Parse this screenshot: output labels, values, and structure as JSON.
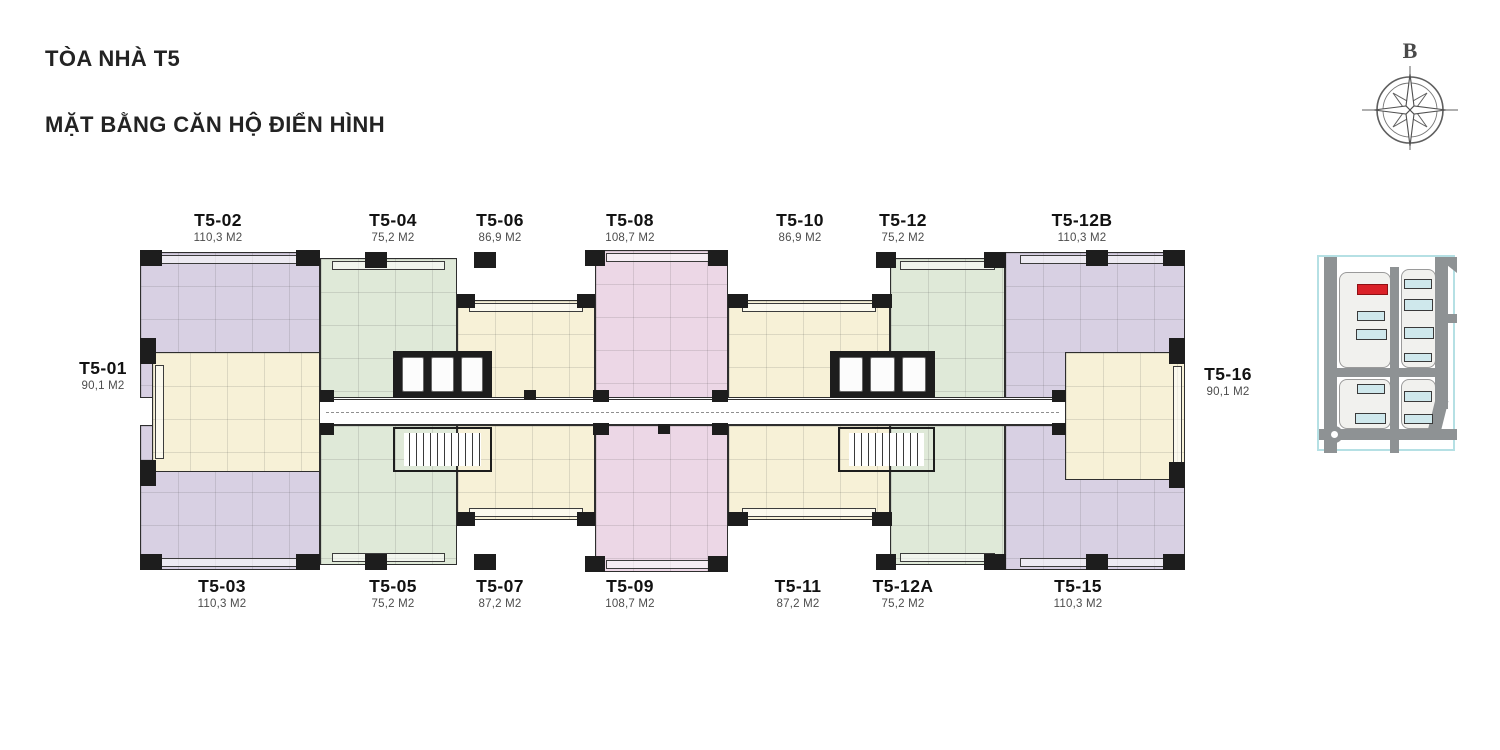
{
  "title": {
    "line1": "TÒA NHÀ T5",
    "line2": "MẶT BẰNG CĂN HỘ ĐIỂN HÌNH"
  },
  "compass": {
    "north_label": "B"
  },
  "colors": {
    "lavender": "#d8d0e3",
    "green": "#dfe9d8",
    "cream": "#f7f1d7",
    "pink": "#ecd7e6",
    "wall": "#1d1d1d",
    "map_road": "#8e9294",
    "map_building_blue": "#cfe8ec",
    "map_building_red": "#da2128",
    "map_border": "#b5e0e4"
  },
  "plan": {
    "units": [
      {
        "id": "T5-02",
        "label": "T5-02",
        "area": "110,3 M2",
        "color": "lavender",
        "rect": [
          140,
          252,
          180,
          146
        ],
        "label_at": [
          218,
          210
        ],
        "balcony": "top"
      },
      {
        "id": "T5-03",
        "label": "T5-03",
        "area": "110,3 M2",
        "color": "lavender",
        "rect": [
          140,
          425,
          180,
          145
        ],
        "label_at": [
          222,
          576
        ],
        "balcony": "bottom"
      },
      {
        "id": "T5-04",
        "label": "T5-04",
        "area": "75,2 M2",
        "color": "green",
        "rect": [
          320,
          258,
          137,
          140
        ],
        "label_at": [
          393,
          210
        ],
        "balcony": "top"
      },
      {
        "id": "T5-05",
        "label": "T5-05",
        "area": "75,2 M2",
        "color": "green",
        "rect": [
          320,
          425,
          137,
          140
        ],
        "label_at": [
          393,
          576
        ],
        "balcony": "bottom"
      },
      {
        "id": "T5-06",
        "label": "T5-06",
        "area": "86,9 M2",
        "color": "cream",
        "rect": [
          457,
          300,
          138,
          98
        ],
        "label_at": [
          500,
          210
        ],
        "balcony": "top"
      },
      {
        "id": "T5-07",
        "label": "T5-07",
        "area": "87,2 M2",
        "color": "cream",
        "rect": [
          457,
          425,
          138,
          95
        ],
        "label_at": [
          500,
          576
        ],
        "balcony": "bottom"
      },
      {
        "id": "T5-08",
        "label": "T5-08",
        "area": "108,7 M2",
        "color": "pink",
        "rect": [
          595,
          250,
          133,
          148
        ],
        "label_at": [
          630,
          210
        ],
        "balcony": "top"
      },
      {
        "id": "T5-09",
        "label": "T5-09",
        "area": "108,7 M2",
        "color": "pink",
        "rect": [
          595,
          425,
          133,
          147
        ],
        "label_at": [
          630,
          576
        ],
        "balcony": "bottom"
      },
      {
        "id": "T5-10",
        "label": "T5-10",
        "area": "86,9 M2",
        "color": "cream",
        "rect": [
          728,
          300,
          162,
          98
        ],
        "label_at": [
          800,
          210
        ],
        "balcony": "top"
      },
      {
        "id": "T5-11",
        "label": "T5-11",
        "area": "87,2 M2",
        "color": "cream",
        "rect": [
          728,
          425,
          162,
          95
        ],
        "label_at": [
          798,
          576
        ],
        "balcony": "bottom"
      },
      {
        "id": "T5-12",
        "label": "T5-12",
        "area": "75,2 M2",
        "color": "green",
        "rect": [
          890,
          258,
          115,
          140
        ],
        "label_at": [
          903,
          210
        ],
        "balcony": "top"
      },
      {
        "id": "T5-12A",
        "label": "T5-12A",
        "area": "75,2 M2",
        "color": "green",
        "rect": [
          890,
          425,
          115,
          140
        ],
        "label_at": [
          903,
          576
        ],
        "balcony": "bottom"
      },
      {
        "id": "T5-12B",
        "label": "T5-12B",
        "area": "110,3 M2",
        "color": "lavender",
        "rect": [
          1005,
          252,
          180,
          146
        ],
        "label_at": [
          1082,
          210
        ],
        "balcony": "top"
      },
      {
        "id": "T5-15",
        "label": "T5-15",
        "area": "110,3 M2",
        "color": "lavender",
        "rect": [
          1005,
          425,
          180,
          145
        ],
        "label_at": [
          1078,
          576
        ],
        "balcony": "bottom"
      },
      {
        "id": "T5-01",
        "label": "T5-01",
        "area": "90,1 M2",
        "color": "cream",
        "rect": [
          152,
          352,
          168,
          120
        ],
        "label_at": [
          103,
          358
        ],
        "balcony": "left"
      },
      {
        "id": "T5-16",
        "label": "T5-16",
        "area": "90,1 M2",
        "color": "cream",
        "rect": [
          1065,
          352,
          120,
          128
        ],
        "label_at": [
          1228,
          364
        ],
        "balcony": "right"
      }
    ],
    "corridor": [
      320,
      399,
      745,
      26
    ],
    "elevator_banks": [
      [
        393,
        351,
        99,
        47
      ],
      [
        830,
        351,
        105,
        47
      ]
    ],
    "elevator_cars_per_bank": 3,
    "stairs": [
      [
        393,
        427,
        99,
        45
      ],
      [
        838,
        427,
        97,
        45
      ]
    ],
    "columns": [
      [
        140,
        250,
        22,
        16
      ],
      [
        296,
        250,
        24,
        16
      ],
      [
        365,
        252,
        22,
        16
      ],
      [
        474,
        252,
        22,
        16
      ],
      [
        585,
        250,
        20,
        16
      ],
      [
        708,
        250,
        20,
        16
      ],
      [
        876,
        252,
        20,
        16
      ],
      [
        984,
        252,
        22,
        16
      ],
      [
        1086,
        250,
        22,
        16
      ],
      [
        1163,
        250,
        22,
        16
      ],
      [
        457,
        294,
        18,
        14
      ],
      [
        577,
        294,
        18,
        14
      ],
      [
        728,
        294,
        20,
        14
      ],
      [
        872,
        294,
        20,
        14
      ],
      [
        140,
        554,
        22,
        16
      ],
      [
        296,
        554,
        24,
        16
      ],
      [
        365,
        554,
        22,
        16
      ],
      [
        474,
        554,
        22,
        16
      ],
      [
        585,
        556,
        20,
        16
      ],
      [
        708,
        556,
        20,
        16
      ],
      [
        876,
        554,
        20,
        16
      ],
      [
        984,
        554,
        22,
        16
      ],
      [
        1086,
        554,
        22,
        16
      ],
      [
        1163,
        554,
        22,
        16
      ],
      [
        457,
        512,
        18,
        14
      ],
      [
        577,
        512,
        18,
        14
      ],
      [
        728,
        512,
        20,
        14
      ],
      [
        872,
        512,
        20,
        14
      ],
      [
        140,
        338,
        16,
        26
      ],
      [
        140,
        460,
        16,
        26
      ],
      [
        1169,
        338,
        16,
        26
      ],
      [
        1169,
        462,
        16,
        26
      ],
      [
        320,
        390,
        14,
        12
      ],
      [
        320,
        423,
        14,
        12
      ],
      [
        593,
        390,
        16,
        12
      ],
      [
        593,
        423,
        16,
        12
      ],
      [
        712,
        390,
        16,
        12
      ],
      [
        712,
        423,
        16,
        12
      ],
      [
        1052,
        390,
        14,
        12
      ],
      [
        1052,
        423,
        14,
        12
      ],
      [
        524,
        390,
        12,
        10
      ],
      [
        658,
        424,
        12,
        10
      ]
    ]
  },
  "site_map": {
    "box": [
      1317,
      255,
      138,
      196
    ],
    "parcels": [
      [
        20,
        15,
        50,
        94
      ],
      [
        82,
        12,
        33,
        97
      ],
      [
        20,
        122,
        50,
        48
      ],
      [
        82,
        122,
        33,
        48
      ]
    ],
    "roads": [
      {
        "rect": [
          5,
          0,
          13,
          196
        ]
      },
      {
        "rect": [
          71,
          10,
          9,
          186
        ]
      },
      {
        "rect": [
          116,
          0,
          13,
          152
        ]
      },
      {
        "rect": [
          116,
          57,
          22,
          9
        ]
      },
      {
        "rect": [
          5,
          111,
          124,
          9
        ]
      },
      {
        "rect": [
          0,
          172,
          138,
          11
        ]
      },
      {
        "rect": [
          112,
          142,
          13,
          38
        ],
        "rot": 14
      },
      {
        "rect": [
          118,
          0,
          20,
          16
        ],
        "corner": true
      }
    ],
    "roundabout": [
      7,
      169,
      17,
      17
    ],
    "buildings": [
      {
        "rect": [
          38,
          27,
          31,
          11
        ],
        "red": true
      },
      {
        "rect": [
          38,
          54,
          28,
          10
        ]
      },
      {
        "rect": [
          37,
          72,
          31,
          11
        ]
      },
      {
        "rect": [
          85,
          22,
          28,
          10
        ]
      },
      {
        "rect": [
          85,
          42,
          29,
          12
        ]
      },
      {
        "rect": [
          85,
          70,
          30,
          12
        ]
      },
      {
        "rect": [
          85,
          96,
          28,
          9
        ]
      },
      {
        "rect": [
          38,
          127,
          28,
          10
        ]
      },
      {
        "rect": [
          36,
          156,
          31,
          11
        ]
      },
      {
        "rect": [
          85,
          134,
          28,
          11
        ]
      },
      {
        "rect": [
          85,
          157,
          29,
          10
        ]
      }
    ]
  }
}
